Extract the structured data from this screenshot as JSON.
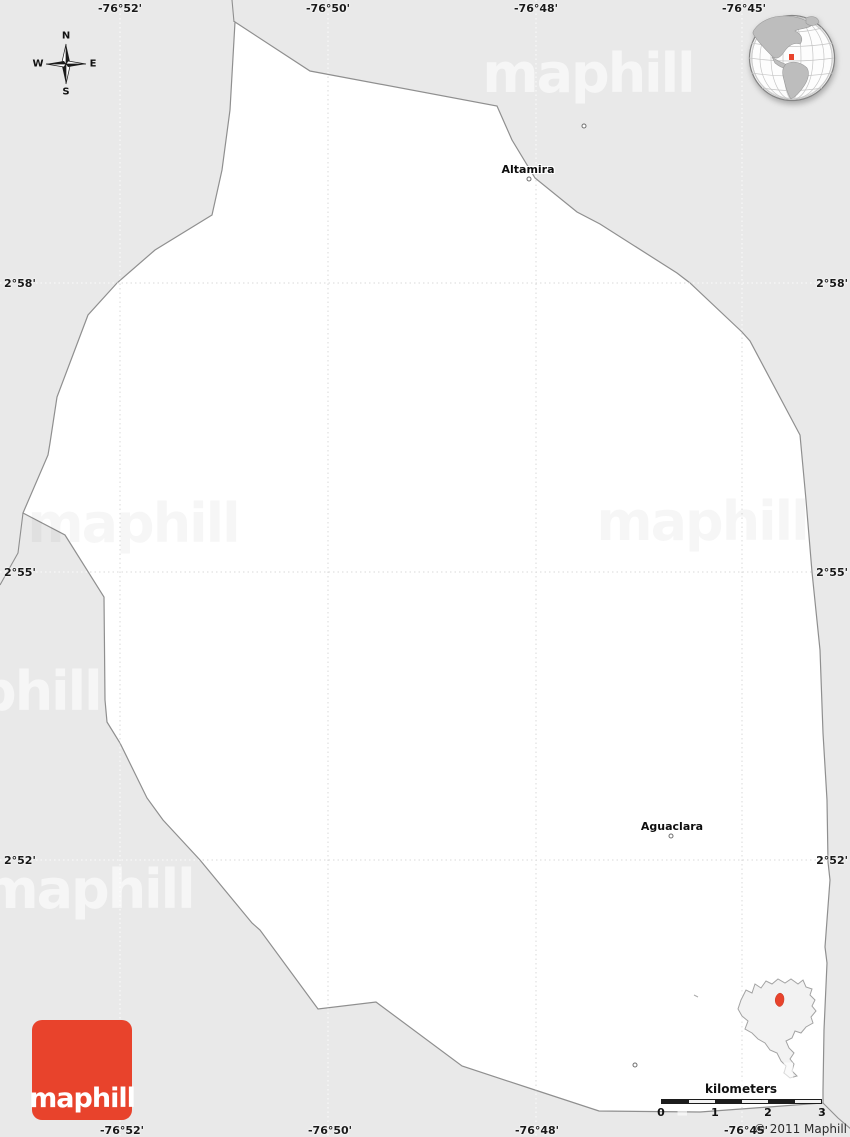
{
  "colors": {
    "background": "#e9e9e9",
    "region_fill": "#ffffff",
    "border": "#8f8f8f",
    "grid_on_region": "#d9d9d9",
    "grid_on_background": "#ffffff",
    "accent_red": "#e8432c",
    "label_color": "#1a1a1a"
  },
  "grid": {
    "meridians": [
      {
        "label": "-76°52'"
      },
      {
        "label": "-76°50'"
      },
      {
        "label": "-76°48'"
      },
      {
        "label": "-76°45'"
      }
    ],
    "parallels": [
      {
        "label": "2°58'"
      },
      {
        "label": "2°55'"
      },
      {
        "label": "2°52'"
      }
    ]
  },
  "places": [
    {
      "name": "Altamira"
    },
    {
      "name": "Aguaclara"
    }
  ],
  "compass": {
    "north": "N",
    "south": "S",
    "east": "E",
    "west": "W"
  },
  "watermark": {
    "text": "maphill"
  },
  "scale_bar": {
    "title": "kilometers",
    "ticks": [
      "0",
      "1",
      "2",
      "3"
    ]
  },
  "logo": {
    "text": "maphill"
  },
  "attribution": "© 2011 Maphill"
}
